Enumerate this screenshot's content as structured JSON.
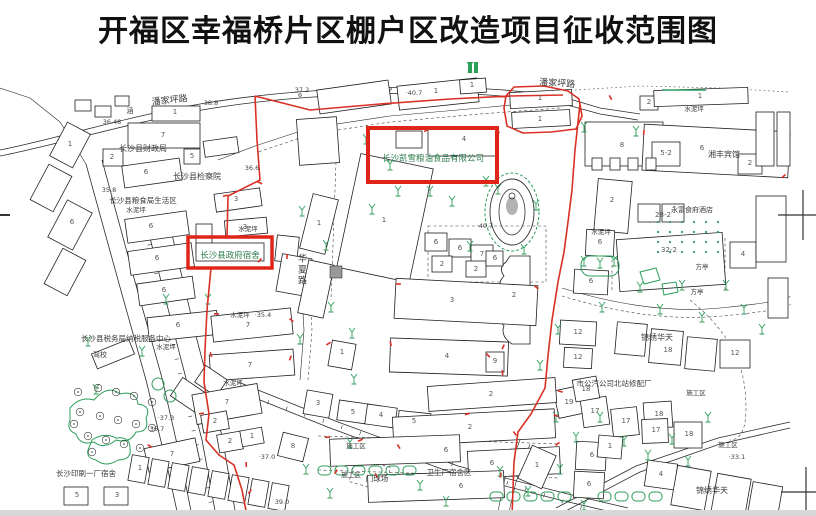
{
  "title": "开福区幸福桥片区棚户区改造项目征收范围图",
  "colors": {
    "boundary": "#d93025",
    "highlight": "#e02518",
    "vegetation": "#2c9e58",
    "label": "#3a3a3a",
    "company": "#2f7d4f",
    "number": "#555555",
    "elevation": "#444444"
  },
  "road_labels": [
    {
      "t": "潘家坪路",
      "x": 170,
      "y": 103,
      "r": -6
    },
    {
      "t": "潘家坪路",
      "x": 557,
      "y": 86,
      "r": 4
    },
    {
      "t": "华夏路",
      "x": 301,
      "y": 270,
      "v": 1
    }
  ],
  "highlight_boxes": [
    {
      "name": "kaixue-company",
      "label": "长沙凯雪粮油食品有限公司",
      "x": 433,
      "y": 161,
      "s": 8.5
    },
    {
      "name": "county-gov-dorm",
      "label": "长沙县政府宿舍",
      "x": 230,
      "y": 258,
      "s": 8.5
    }
  ],
  "place_labels": [
    {
      "t": "长沙县财政局",
      "x": 143,
      "y": 151,
      "s": 8
    },
    {
      "t": "长沙县检察院",
      "x": 197,
      "y": 179,
      "s": 8
    },
    {
      "t": "长沙县粮食局生活区",
      "x": 143,
      "y": 203,
      "s": 7.5
    },
    {
      "t": "长沙县税务局纳税服务中心",
      "x": 126,
      "y": 341,
      "s": 7.5
    },
    {
      "t": "驾校",
      "x": 100,
      "y": 357,
      "s": 7
    },
    {
      "t": "长沙印刷一厂宿舍",
      "x": 86,
      "y": 476,
      "s": 7.5
    },
    {
      "t": "市公汽公司北站修配厂",
      "x": 614,
      "y": 386,
      "s": 7.5
    },
    {
      "t": "湘丰宾馆",
      "x": 724,
      "y": 157,
      "s": 8
    },
    {
      "t": "永富食府酒店",
      "x": 692,
      "y": 212,
      "s": 7
    },
    {
      "t": "锦绣华天",
      "x": 657,
      "y": 340,
      "s": 8
    },
    {
      "t": "锦绣华天",
      "x": 712,
      "y": 493,
      "s": 8
    },
    {
      "t": "卫生厂宿舍区",
      "x": 449,
      "y": 475,
      "s": 7.5
    },
    {
      "t": "门球场",
      "x": 377,
      "y": 481,
      "s": 7.5
    },
    {
      "t": "方亭",
      "x": 702,
      "y": 269,
      "s": 6.5
    },
    {
      "t": "方亭",
      "x": 697,
      "y": 294,
      "s": 6.5
    },
    {
      "t": "涵",
      "x": 130,
      "y": 113,
      "s": 7
    },
    {
      "t": "水泥坪",
      "x": 694,
      "y": 111,
      "s": 6.5
    },
    {
      "t": "水泥坪",
      "x": 601,
      "y": 234,
      "s": 6.5
    },
    {
      "t": "水泥坪",
      "x": 240,
      "y": 317,
      "s": 6.5
    },
    {
      "t": "水泥坪",
      "x": 166,
      "y": 349,
      "s": 6.5
    },
    {
      "t": "水泥坪",
      "x": 233,
      "y": 385,
      "s": 6.5
    },
    {
      "t": "水泥坪",
      "x": 136,
      "y": 212,
      "s": 6.5
    },
    {
      "t": "水泥坪",
      "x": 248,
      "y": 231,
      "s": 6.5
    },
    {
      "t": "施工区",
      "x": 356,
      "y": 448,
      "s": 6.5
    },
    {
      "t": "施工区",
      "x": 351,
      "y": 477,
      "s": 6.5
    },
    {
      "t": "施工区",
      "x": 696,
      "y": 395,
      "s": 6.5
    },
    {
      "t": "施工区",
      "x": 728,
      "y": 447,
      "s": 6.5
    }
  ],
  "elevation_labels": [
    {
      "t": "38.8",
      "x": 211,
      "y": 105
    },
    {
      "t": "36.48",
      "x": 112,
      "y": 124
    },
    {
      "t": "35.8",
      "x": 109,
      "y": 192
    },
    {
      "t": "36.6",
      "x": 252,
      "y": 170
    },
    {
      "t": "37.2",
      "x": 302,
      "y": 92
    },
    {
      "t": "·40.7",
      "x": 414,
      "y": 95
    },
    {
      "t": "·40.7",
      "x": 485,
      "y": 228
    },
    {
      "t": "·35.4",
      "x": 263,
      "y": 317
    },
    {
      "t": "·37.3",
      "x": 166,
      "y": 420
    },
    {
      "t": "36.7",
      "x": 157,
      "y": 431
    },
    {
      "t": "·37.0",
      "x": 267,
      "y": 459
    },
    {
      "t": "·33.1",
      "x": 737,
      "y": 459
    },
    {
      "t": "39.0",
      "x": 282,
      "y": 504
    }
  ],
  "building_numbers": [
    {
      "t": "1",
      "x": 175,
      "y": 114
    },
    {
      "t": "7",
      "x": 163,
      "y": 137
    },
    {
      "t": "2",
      "x": 112,
      "y": 159
    },
    {
      "t": "1",
      "x": 70,
      "y": 146
    },
    {
      "t": "6",
      "x": 146,
      "y": 174
    },
    {
      "t": "5",
      "x": 192,
      "y": 158
    },
    {
      "t": "6",
      "x": 72,
      "y": 224
    },
    {
      "t": "6",
      "x": 151,
      "y": 228
    },
    {
      "t": "6",
      "x": 157,
      "y": 260
    },
    {
      "t": "6",
      "x": 164,
      "y": 292
    },
    {
      "t": "6",
      "x": 178,
      "y": 327
    },
    {
      "t": "7",
      "x": 248,
      "y": 327
    },
    {
      "t": "7",
      "x": 250,
      "y": 367
    },
    {
      "t": "3",
      "x": 245,
      "y": 229
    },
    {
      "t": "3",
      "x": 236,
      "y": 201
    },
    {
      "t": "1",
      "x": 384,
      "y": 222
    },
    {
      "t": "4",
      "x": 464,
      "y": 141
    },
    {
      "t": "6",
      "x": 436,
      "y": 244
    },
    {
      "t": "6",
      "x": 460,
      "y": 250
    },
    {
      "t": "7",
      "x": 482,
      "y": 256
    },
    {
      "t": "2",
      "x": 442,
      "y": 266
    },
    {
      "t": "2",
      "x": 476,
      "y": 271
    },
    {
      "t": "6",
      "x": 495,
      "y": 260
    },
    {
      "t": "3",
      "x": 452,
      "y": 302
    },
    {
      "t": "4",
      "x": 447,
      "y": 358
    },
    {
      "t": "2",
      "x": 514,
      "y": 297
    },
    {
      "t": "9",
      "x": 495,
      "y": 363
    },
    {
      "t": "1",
      "x": 342,
      "y": 354
    },
    {
      "t": "1",
      "x": 319,
      "y": 225
    },
    {
      "t": "5",
      "x": 353,
      "y": 414
    },
    {
      "t": "4",
      "x": 381,
      "y": 417
    },
    {
      "t": "5",
      "x": 414,
      "y": 423
    },
    {
      "t": "3",
      "x": 318,
      "y": 405
    },
    {
      "t": "1",
      "x": 436,
      "y": 93
    },
    {
      "t": "1",
      "x": 472,
      "y": 87
    },
    {
      "t": "1",
      "x": 540,
      "y": 100
    },
    {
      "t": "1",
      "x": 540,
      "y": 121
    },
    {
      "t": "8",
      "x": 622,
      "y": 147
    },
    {
      "t": "2",
      "x": 649,
      "y": 104
    },
    {
      "t": "1",
      "x": 700,
      "y": 98
    },
    {
      "t": "6",
      "x": 702,
      "y": 150
    },
    {
      "t": "5-2",
      "x": 666,
      "y": 155
    },
    {
      "t": "2",
      "x": 750,
      "y": 165
    },
    {
      "t": "2",
      "x": 612,
      "y": 202
    },
    {
      "t": "28-2",
      "x": 663,
      "y": 217
    },
    {
      "t": "32-2",
      "x": 669,
      "y": 252
    },
    {
      "t": "6",
      "x": 600,
      "y": 244
    },
    {
      "t": "6",
      "x": 591,
      "y": 283
    },
    {
      "t": "4",
      "x": 743,
      "y": 256
    },
    {
      "t": "12",
      "x": 578,
      "y": 334
    },
    {
      "t": "12",
      "x": 578,
      "y": 359
    },
    {
      "t": "18",
      "x": 668,
      "y": 352
    },
    {
      "t": "12",
      "x": 735,
      "y": 355
    },
    {
      "t": "19",
      "x": 569,
      "y": 404
    },
    {
      "t": "17",
      "x": 595,
      "y": 413
    },
    {
      "t": "17",
      "x": 626,
      "y": 423
    },
    {
      "t": "18",
      "x": 586,
      "y": 391
    },
    {
      "t": "18",
      "x": 659,
      "y": 416
    },
    {
      "t": "17",
      "x": 656,
      "y": 432
    },
    {
      "t": "18",
      "x": 689,
      "y": 436
    },
    {
      "t": "6",
      "x": 592,
      "y": 457
    },
    {
      "t": "6",
      "x": 589,
      "y": 486
    },
    {
      "t": "4",
      "x": 661,
      "y": 476
    },
    {
      "t": "1",
      "x": 610,
      "y": 448
    },
    {
      "t": "2",
      "x": 491,
      "y": 396
    },
    {
      "t": "2",
      "x": 470,
      "y": 429
    },
    {
      "t": "6",
      "x": 446,
      "y": 452
    },
    {
      "t": "6",
      "x": 492,
      "y": 465
    },
    {
      "t": "6",
      "x": 461,
      "y": 488
    },
    {
      "t": "1",
      "x": 537,
      "y": 467
    },
    {
      "t": "7",
      "x": 227,
      "y": 404
    },
    {
      "t": "7",
      "x": 172,
      "y": 456
    },
    {
      "t": "8",
      "x": 293,
      "y": 448
    },
    {
      "t": "2",
      "x": 215,
      "y": 423
    },
    {
      "t": "2",
      "x": 230,
      "y": 443
    },
    {
      "t": "1",
      "x": 252,
      "y": 438
    },
    {
      "t": "3",
      "x": 117,
      "y": 497
    },
    {
      "t": "5",
      "x": 77,
      "y": 497
    },
    {
      "t": "1",
      "x": 140,
      "y": 470
    }
  ]
}
